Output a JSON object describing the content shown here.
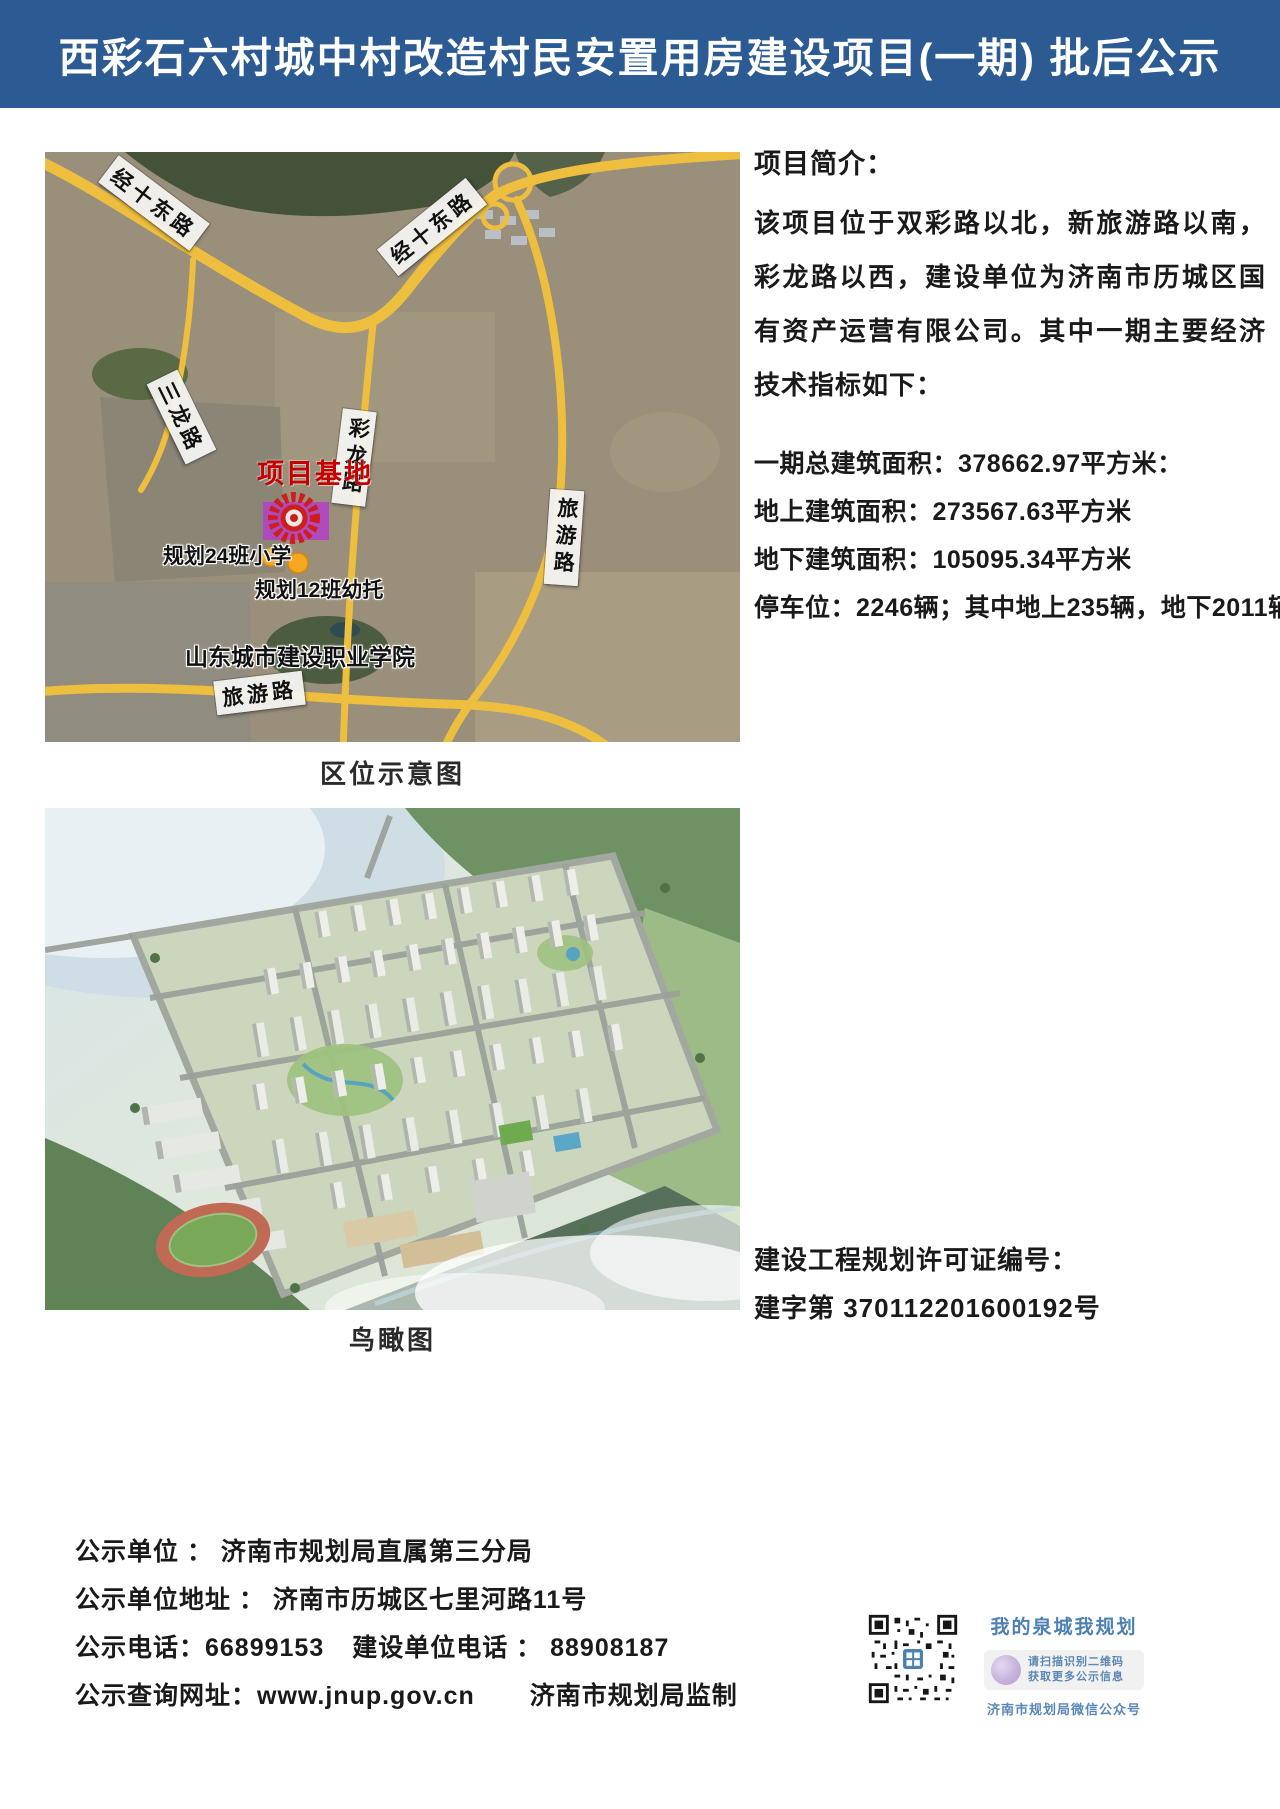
{
  "header": {
    "title": "西彩石六村城中村改造村民安置用房建设项目(一期) 批后公示"
  },
  "location_map": {
    "caption": "区位示意图",
    "roads": {
      "jingshi_east_1": "经十东路",
      "jingshi_east_2": "经十东路",
      "sanlong": "三龙路",
      "cailong": "彩龙路",
      "lvyou_right": "旅游路",
      "lvyou_bottom": "旅游路"
    },
    "site_label": "项目基地",
    "school_label": "规划24班小学",
    "kindergarten_label": "规划12班幼托",
    "college_label": "山东城市建设职业学院"
  },
  "intro": {
    "heading": "项目简介：",
    "paragraph": "该项目位于双彩路以北，新旅游路以南，彩龙路以西，建设单位为济南市历城区国有资产运营有限公司。其中一期主要经济技术指标如下：",
    "indicators": [
      "一期总建筑面积：378662.97平方米：",
      "地上建筑面积：273567.63平方米",
      "地下建筑面积：105095.34平方米",
      "停车位：2246辆；其中地上235辆，地下2011辆"
    ]
  },
  "birdseye": {
    "caption": "鸟瞰图"
  },
  "permit": {
    "line1": "建设工程规划许可证编号：",
    "line2": "建字第 370112201600192号"
  },
  "footer": {
    "unit": "公示单位 ： 济南市规划局直属第三分局",
    "address": "公示单位地址 ： 济南市历城区七里河路11号",
    "phone": "公示电话：66899153",
    "builder_phone": "建设单位电话 ： 88908187",
    "website": "公示查询网址：www.jnup.gov.cn",
    "supervisor": "济南市规划局监制"
  },
  "wechat": {
    "slogan": "我的泉城我规划",
    "tip1": "请扫描识别二维码",
    "tip2": "获取更多公示信息",
    "account": "济南市规划局微信公众号"
  },
  "colors": {
    "header_bg": "#2b5b92",
    "site_red": "#c40000",
    "road_yellow": "#eebe3e",
    "wechat_blue": "#4d80b2"
  }
}
